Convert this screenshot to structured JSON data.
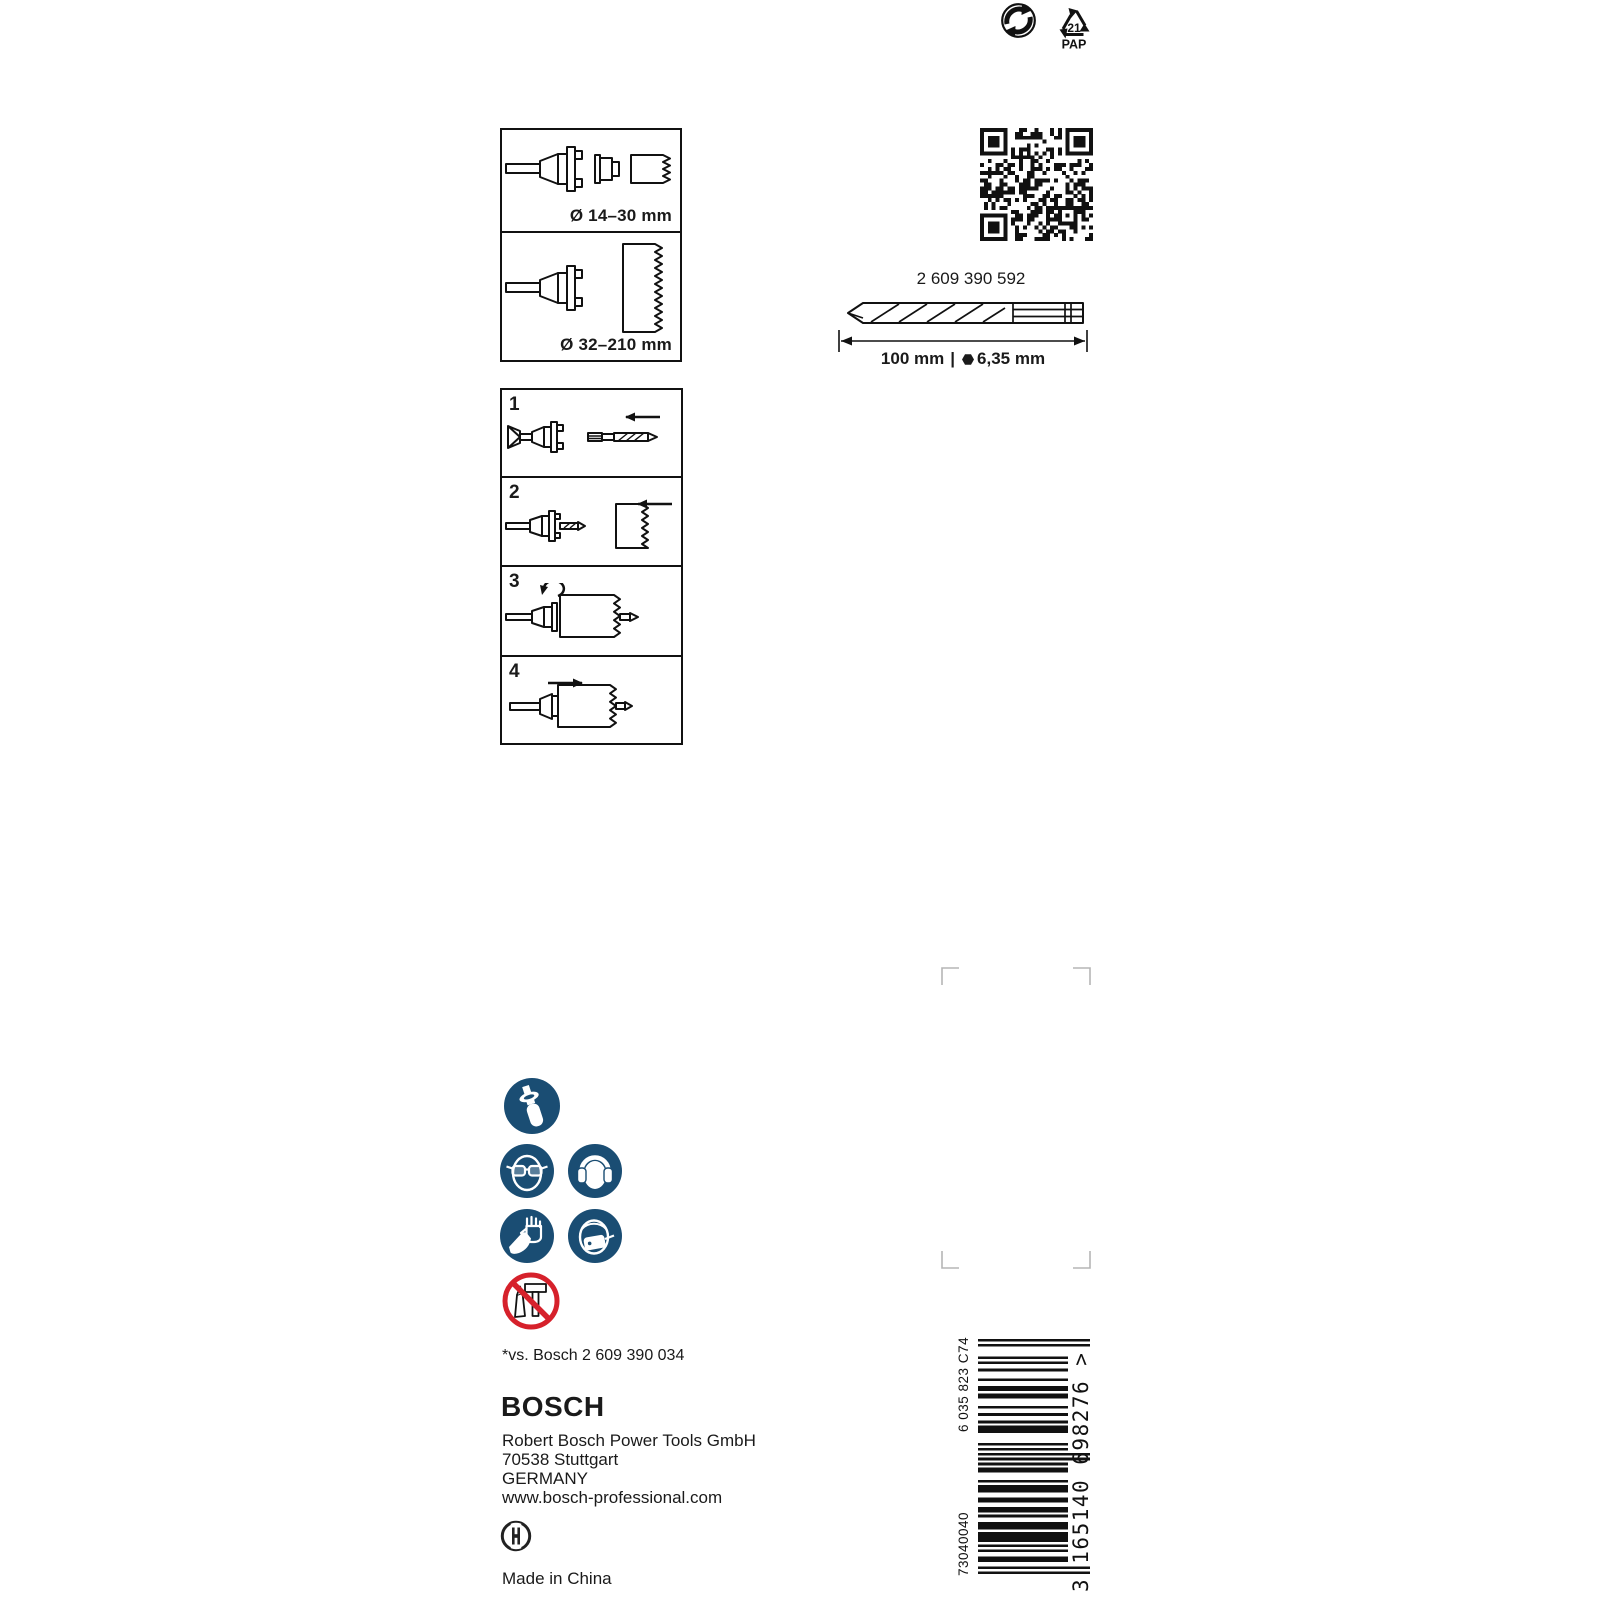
{
  "colors": {
    "safety_blue": "#1a4d73",
    "prohibition_red": "#d6212b",
    "ink": "#1a1a1a",
    "crop_mark_gray": "#b5b5b5"
  },
  "recycling": {
    "pap_code": "21",
    "pap_label": "PAP"
  },
  "compatibility": {
    "small_range": "Ø 14–30 mm",
    "large_range": "Ø 32–210 mm"
  },
  "steps": [
    {
      "n": "1"
    },
    {
      "n": "2"
    },
    {
      "n": "3"
    },
    {
      "n": "4"
    }
  ],
  "pilot_bit": {
    "part_number": "2 609 390 592",
    "length": "100 mm",
    "separator": "|",
    "hex_size": "6,35 mm"
  },
  "footnote": "*vs. Bosch 2 609 390 034",
  "manufacturer": {
    "brand": "BOSCH",
    "address": [
      "Robert Bosch Power Tools GmbH",
      "70538 Stuttgart",
      "GERMANY",
      "www.bosch-professional.com"
    ],
    "made_in": "Made in China"
  },
  "barcode": {
    "batch_code": "6 035 823 C74",
    "order_code": "73040040",
    "ean_display": "3 165140 698276 >",
    "ean_digits": "3165140698276"
  }
}
